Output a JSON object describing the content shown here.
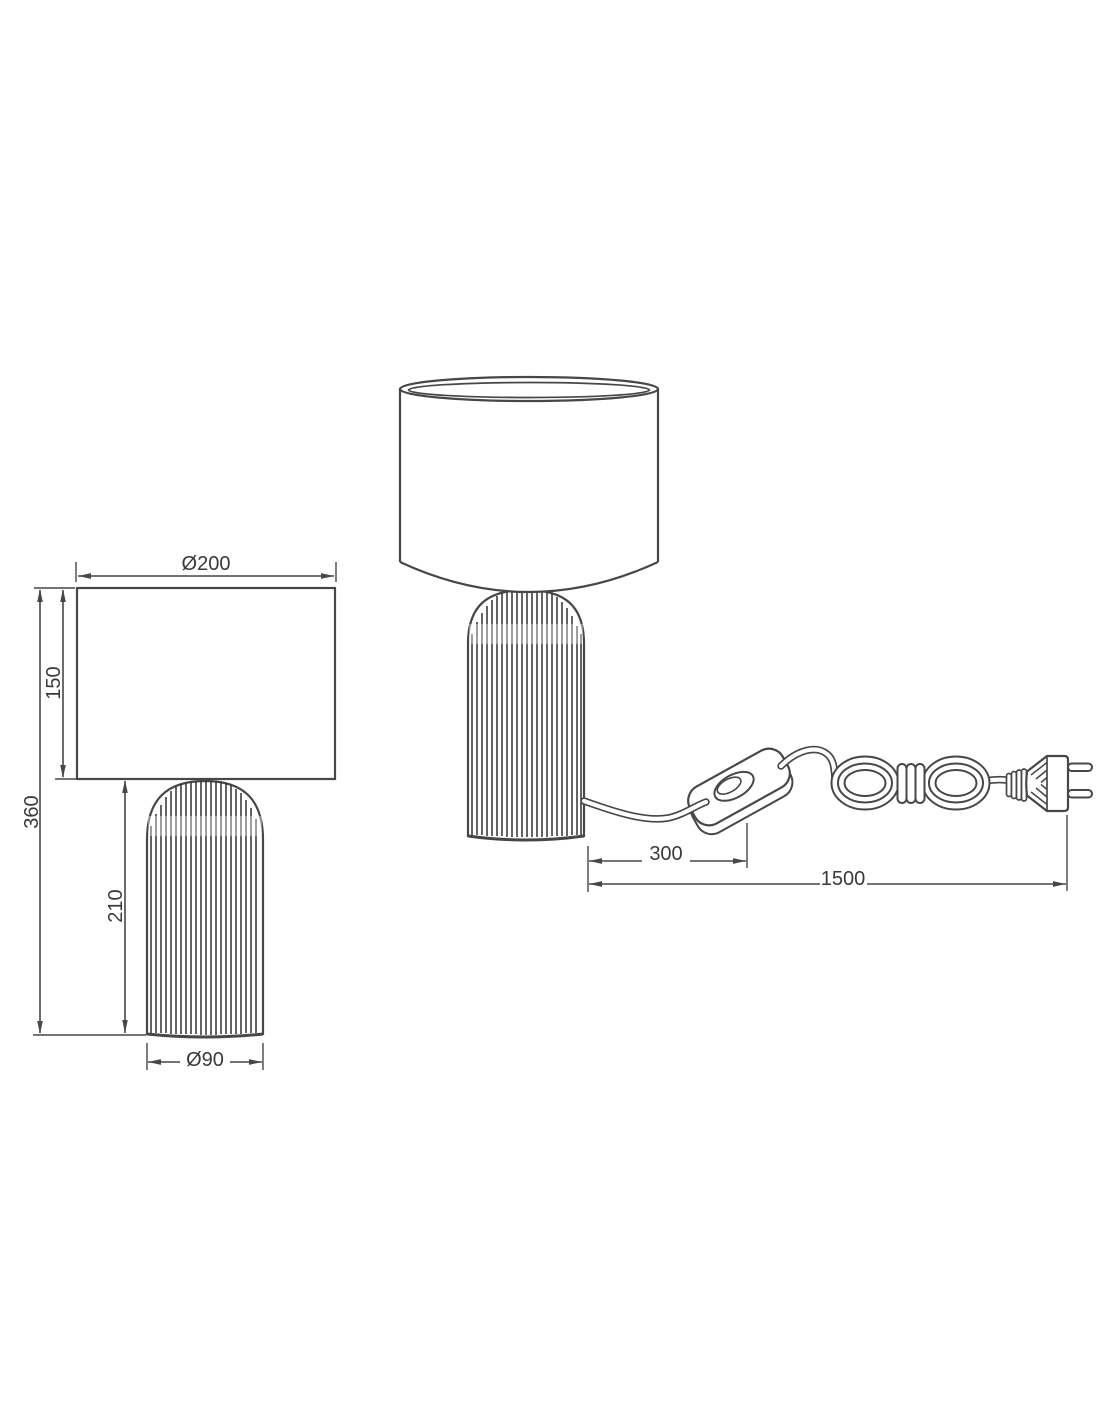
{
  "front_view": {
    "labels": {
      "shade_diameter": "Ø200",
      "shade_height": "150",
      "total_height": "360",
      "base_height": "210",
      "base_diameter": "Ø90"
    }
  },
  "side_view": {
    "labels": {
      "switch_distance": "300",
      "cable_length": "1500"
    }
  },
  "colors": {
    "line": "#474747",
    "text": "#3a3a3a",
    "background": "#ffffff"
  }
}
